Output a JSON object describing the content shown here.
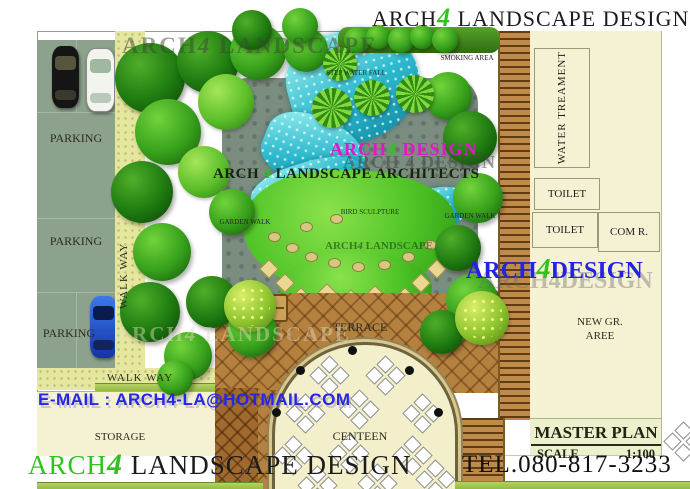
{
  "branding": {
    "top_title": {
      "arch": "ARCH",
      "four": "4",
      "rest": " LANDSCAPE DESIGN"
    },
    "bottom_brand": {
      "arch": "ARCH",
      "four": "4",
      "rest": " LANDSCAPE DESIGN"
    },
    "tel": "TEL.080-817-3233",
    "email": "E-MAIL : ARCH4-LA@HOTMAIL.COM"
  },
  "title_block": {
    "title": "MASTER PLAN",
    "scale_label": "SCALE",
    "scale_value": "1:100"
  },
  "watermarks": {
    "top": {
      "arch": "ARCH",
      "four": "4",
      "rest": " LANDSCAPE"
    },
    "left": {
      "arch": "ARCH",
      "four": "4",
      "rest": " LANDSCAPE"
    },
    "center_magenta": {
      "arch": "ARCH",
      "four": "4",
      "rest": " DESIGN"
    },
    "center_shadow": "ARCH 4 DESIGN",
    "architects": {
      "arch": "ARCH ",
      "four": "4",
      "rest": " LANDSCAPE ARCHITECTS"
    },
    "lawn": {
      "arch": "ARCH",
      "four": "4",
      "rest": " LANDSCAPE"
    },
    "blue": {
      "arch": "ARCH",
      "four": "4",
      "rest": "DESIGN"
    },
    "blue_shadow": "ARCH4DESIGN"
  },
  "labels": {
    "parking_top": "PARKING",
    "parking_mid": "PARKING",
    "parking_bottom": "PARKING",
    "walkway_side": "WALK WAY",
    "walkway_bottom": "WALK WAY",
    "storage": "STORAGE",
    "terrace": "TERRACE",
    "canteen": "CENTEEN",
    "water_treatment": "WATER TREAMENT",
    "toilet_1": "TOILET",
    "toilet_2": "TOILET",
    "com_room": "COM R.",
    "new_green_line1": "NEW GR.",
    "new_green_line2": "AREE",
    "smoking_area": "SMOKING AREA",
    "step_water_fall": "STEP WATER FALL",
    "garden_walk_left": "GARDEN WALK",
    "garden_walk_right": "GARDEN WALK",
    "sculpture": "BIRD SCULPTURE"
  },
  "colors": {
    "brand_green": "#2fc31d",
    "brand_blue": "#2323e6",
    "magenta": "#e018c8",
    "title_dark": "#1c1c1c"
  }
}
